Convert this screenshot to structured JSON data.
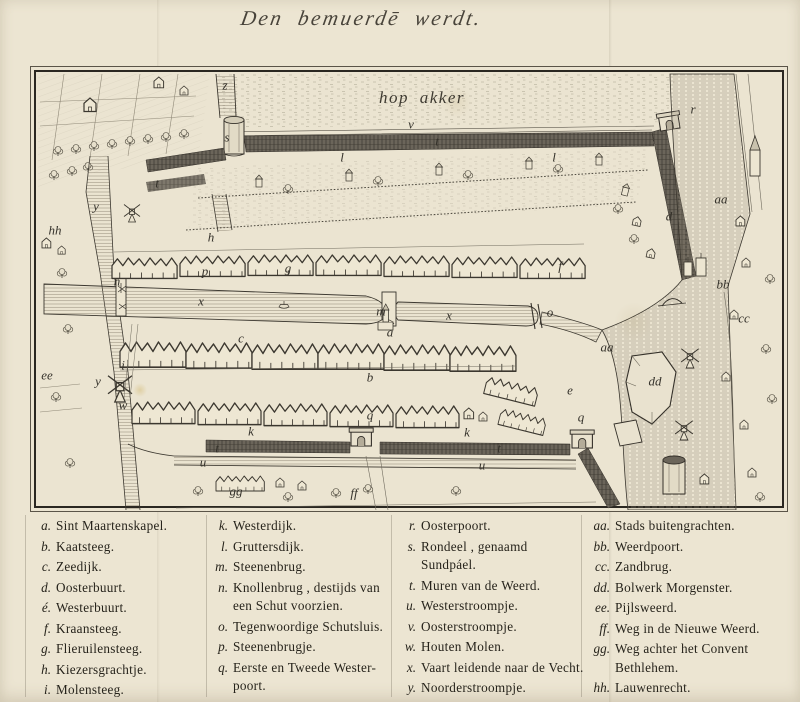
{
  "title": "Den bemuerdē werdt.",
  "map": {
    "field_label": "hop akker",
    "markers": [
      {
        "t": "z",
        "x": 190,
        "y": 14
      },
      {
        "t": "s",
        "x": 192,
        "y": 66
      },
      {
        "t": "v",
        "x": 376,
        "y": 53
      },
      {
        "t": "t",
        "x": 402,
        "y": 70
      },
      {
        "t": "t",
        "x": 122,
        "y": 112
      },
      {
        "t": "t",
        "x": 182,
        "y": 377
      },
      {
        "t": "t",
        "x": 464,
        "y": 377
      },
      {
        "t": "r",
        "x": 658,
        "y": 38
      },
      {
        "t": "aa",
        "x": 686,
        "y": 128
      },
      {
        "t": "aa",
        "x": 572,
        "y": 276
      },
      {
        "t": "d",
        "x": 634,
        "y": 145
      },
      {
        "t": "l",
        "x": 307,
        "y": 86
      },
      {
        "t": "l",
        "x": 519,
        "y": 86
      },
      {
        "t": "hh",
        "x": 20,
        "y": 159
      },
      {
        "t": "y",
        "x": 61,
        "y": 135
      },
      {
        "t": "y",
        "x": 63,
        "y": 310
      },
      {
        "t": "h",
        "x": 176,
        "y": 166
      },
      {
        "t": "p",
        "x": 170,
        "y": 200
      },
      {
        "t": "n",
        "x": 82,
        "y": 210
      },
      {
        "t": "x",
        "x": 166,
        "y": 230
      },
      {
        "t": "x",
        "x": 414,
        "y": 244
      },
      {
        "t": "g",
        "x": 253,
        "y": 197
      },
      {
        "t": "m",
        "x": 346,
        "y": 240
      },
      {
        "t": "a",
        "x": 355,
        "y": 261
      },
      {
        "t": "i",
        "x": 88,
        "y": 294
      },
      {
        "t": "c",
        "x": 206,
        "y": 267
      },
      {
        "t": "f",
        "x": 525,
        "y": 195
      },
      {
        "t": "o",
        "x": 515,
        "y": 241
      },
      {
        "t": "bb",
        "x": 688,
        "y": 213
      },
      {
        "t": "cc",
        "x": 709,
        "y": 247
      },
      {
        "t": "ee",
        "x": 12,
        "y": 304
      },
      {
        "t": "w",
        "x": 88,
        "y": 334
      },
      {
        "t": "k",
        "x": 216,
        "y": 360
      },
      {
        "t": "k",
        "x": 432,
        "y": 361
      },
      {
        "t": "u",
        "x": 168,
        "y": 391
      },
      {
        "t": "u",
        "x": 447,
        "y": 394
      },
      {
        "t": "gg",
        "x": 201,
        "y": 420
      },
      {
        "t": "ff",
        "x": 319,
        "y": 422
      },
      {
        "t": "b",
        "x": 335,
        "y": 306
      },
      {
        "t": "q",
        "x": 335,
        "y": 344
      },
      {
        "t": "q",
        "x": 546,
        "y": 346
      },
      {
        "t": "e",
        "x": 535,
        "y": 319
      },
      {
        "t": "dd",
        "x": 620,
        "y": 310
      }
    ]
  },
  "legend": {
    "columns": [
      {
        "items": [
          {
            "key": "a.",
            "label": "Sint Maartenskapel."
          },
          {
            "key": "b.",
            "label": "Kaatsteeg."
          },
          {
            "key": "c.",
            "label": "Zeedijk."
          },
          {
            "key": "d.",
            "label": "Oosterbuurt."
          },
          {
            "key": "é.",
            "label": "Westerbuurt."
          },
          {
            "key": "f.",
            "label": "Kraansteeg."
          },
          {
            "key": "g.",
            "label": "Flieruilensteeg."
          },
          {
            "key": "h.",
            "label": "Kiezersgrachtje."
          },
          {
            "key": "i.",
            "label": "Molensteeg."
          }
        ]
      },
      {
        "items": [
          {
            "key": "k.",
            "label": "Westerdijk."
          },
          {
            "key": "l.",
            "label": "Gruttersdijk."
          },
          {
            "key": "m.",
            "label": "Steenenbrug."
          },
          {
            "key": "n.",
            "label": "Knollenbrug , destijds van\neen Schut voorzien."
          },
          {
            "key": "o.",
            "label": "Tegenwoordige Schutsluis."
          },
          {
            "key": "p.",
            "label": "Steenenbrugje."
          },
          {
            "key": "q.",
            "label": "Eerste en Tweede Wester-\npoort."
          }
        ]
      },
      {
        "items": [
          {
            "key": "r.",
            "label": "Oosterpoort."
          },
          {
            "key": "s.",
            "label": "Rondeel , genaamd Sundpáel."
          },
          {
            "key": "t.",
            "label": "Muren van de Weerd."
          },
          {
            "key": "u.",
            "label": "Westerstroompje."
          },
          {
            "key": "v.",
            "label": "Oosterstroompje."
          },
          {
            "key": "w.",
            "label": "Houten Molen."
          },
          {
            "key": "x.",
            "label": "Vaart leidende naar de Vecht."
          },
          {
            "key": "y.",
            "label": "Noorderstroompje."
          },
          {
            "key": "z.",
            "label": "Zwarte Water."
          }
        ]
      },
      {
        "items": [
          {
            "key": "aa.",
            "label": "Stads buitengrachten."
          },
          {
            "key": "bb.",
            "label": "Weerdpoort."
          },
          {
            "key": "cc.",
            "label": "Zandbrug."
          },
          {
            "key": "dd.",
            "label": "Bolwerk Morgenster."
          },
          {
            "key": "ee.",
            "label": "Pijlsweerd."
          },
          {
            "key": "ff.",
            "label": "Weg in de Nieuwe Weerd."
          },
          {
            "key": "gg.",
            "label": "Weg achter het Convent\nBethlehem."
          },
          {
            "key": "hh.",
            "label": "Lauwenrecht."
          }
        ]
      }
    ]
  },
  "colors": {
    "paper": "#ece5d2",
    "ink": "#3b372f",
    "wall": "#6b655a"
  }
}
